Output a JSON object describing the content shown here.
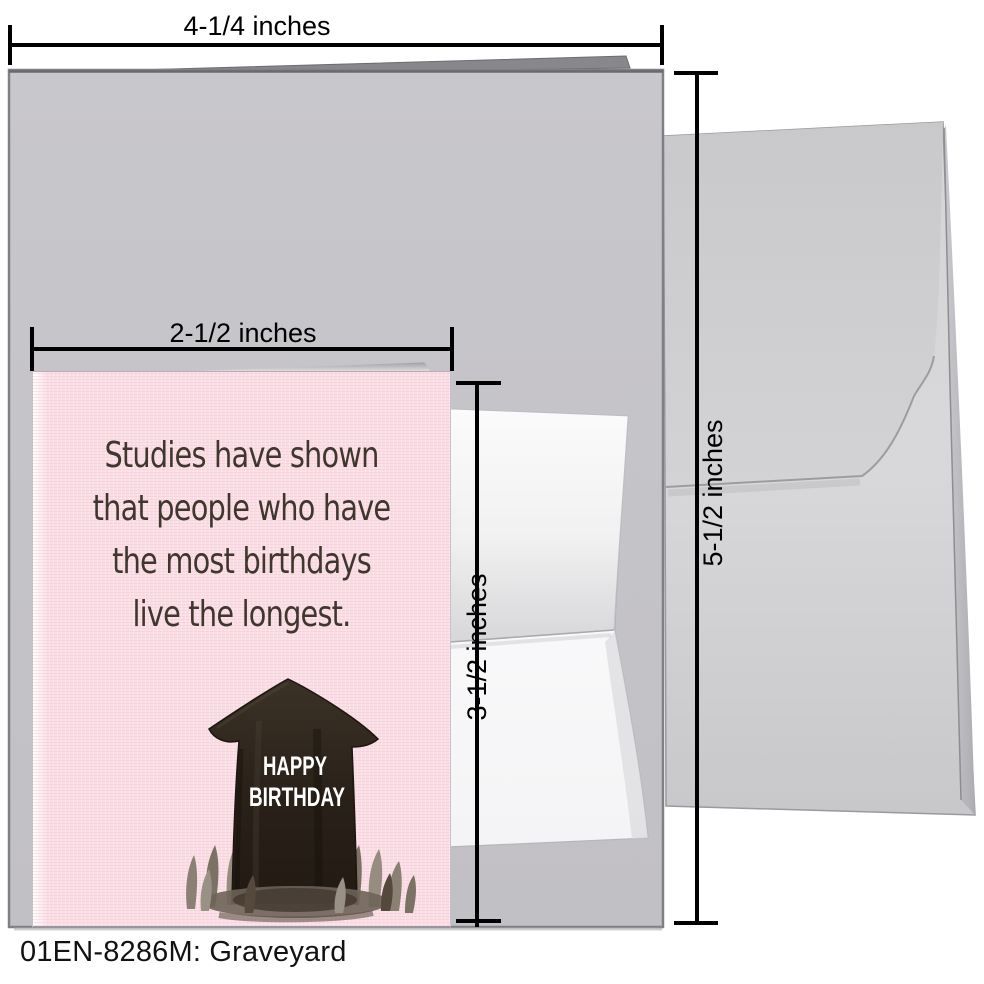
{
  "product": {
    "caption": "01EN-8286M: Graveyard"
  },
  "dimensions": {
    "card_width": "4-1/4 inches",
    "card_height": "5-1/2 inches",
    "notecard_width": "2-1/2 inches",
    "notecard_height": "3-1/2 inches"
  },
  "notecard": {
    "message_lines": [
      "Studies have shown",
      "that people who have",
      "the most birthdays",
      "live the longest."
    ],
    "tombstone_line1": "HAPPY",
    "tombstone_line2": "BIRTHDAY"
  },
  "colors": {
    "notecard_pink": "#fadee5",
    "message_brown": "#3f372e",
    "big_card_gray": "#c5c4c8",
    "envelope_gray": "#d3d3d5",
    "stone_dark": "#2a2119",
    "grass_taupe": "#8a8074",
    "dimension_line": "#000000"
  }
}
